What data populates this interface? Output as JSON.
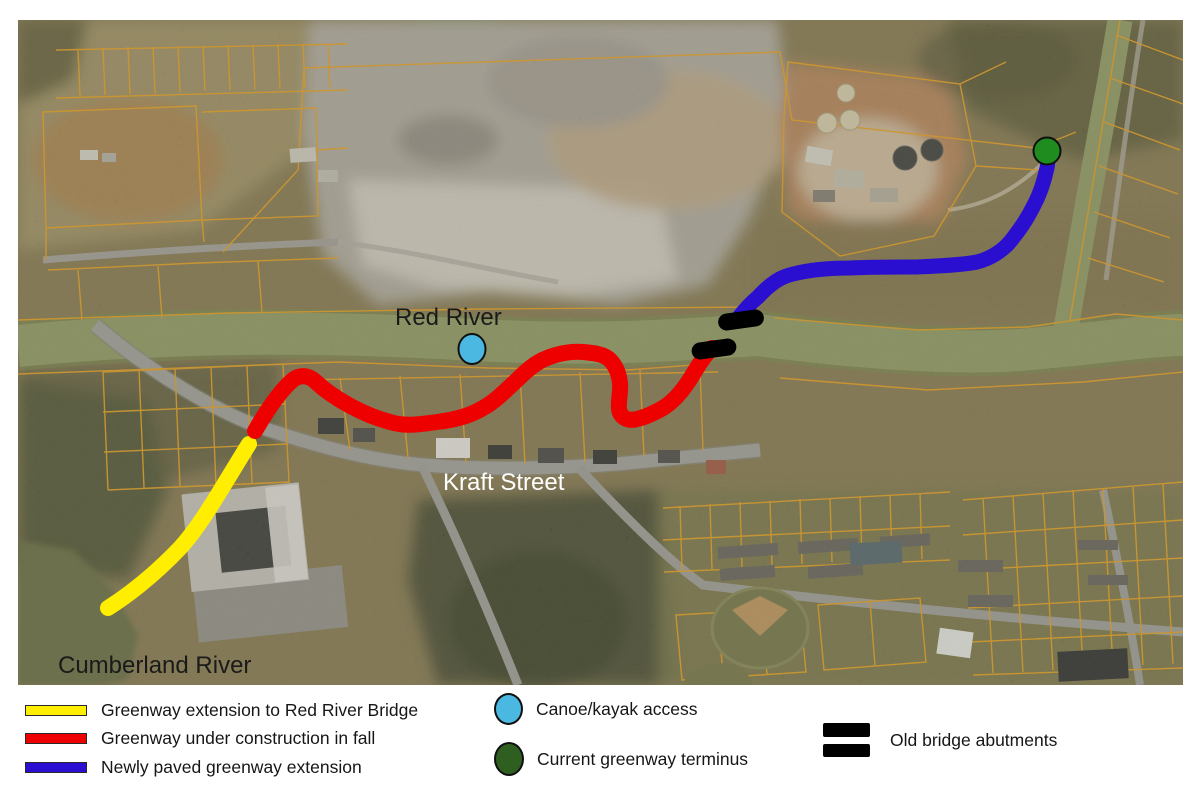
{
  "map": {
    "labels": {
      "red_river": "Red River",
      "kraft_street": "Kraft Street",
      "cumberland_river": "Cumberland River"
    },
    "colors": {
      "route_yellow": "#FFEE00",
      "route_red": "#EE0000",
      "route_blue": "#2A0FD0",
      "canoe_access_fill": "#4AB8E0",
      "terminus_fill": "#1F8C1F",
      "abutment_fill": "#000000"
    }
  },
  "legend": {
    "items": [
      {
        "id": "yellow-route",
        "label": "Greenway extension to Red River Bridge",
        "color": "#FFEE00"
      },
      {
        "id": "red-route",
        "label": "Greenway under construction in fall",
        "color": "#EE0000"
      },
      {
        "id": "blue-route",
        "label": "Newly paved greenway extension",
        "color": "#2A0FD0"
      },
      {
        "id": "canoe-access",
        "label": "Canoe/kayak access",
        "color": "#4AB8E0"
      },
      {
        "id": "greenway-terminus",
        "label": "Current greenway terminus",
        "color": "#2E5F20"
      },
      {
        "id": "bridge-abutments",
        "label": "Old bridge abutments",
        "color": "#000000"
      }
    ]
  }
}
